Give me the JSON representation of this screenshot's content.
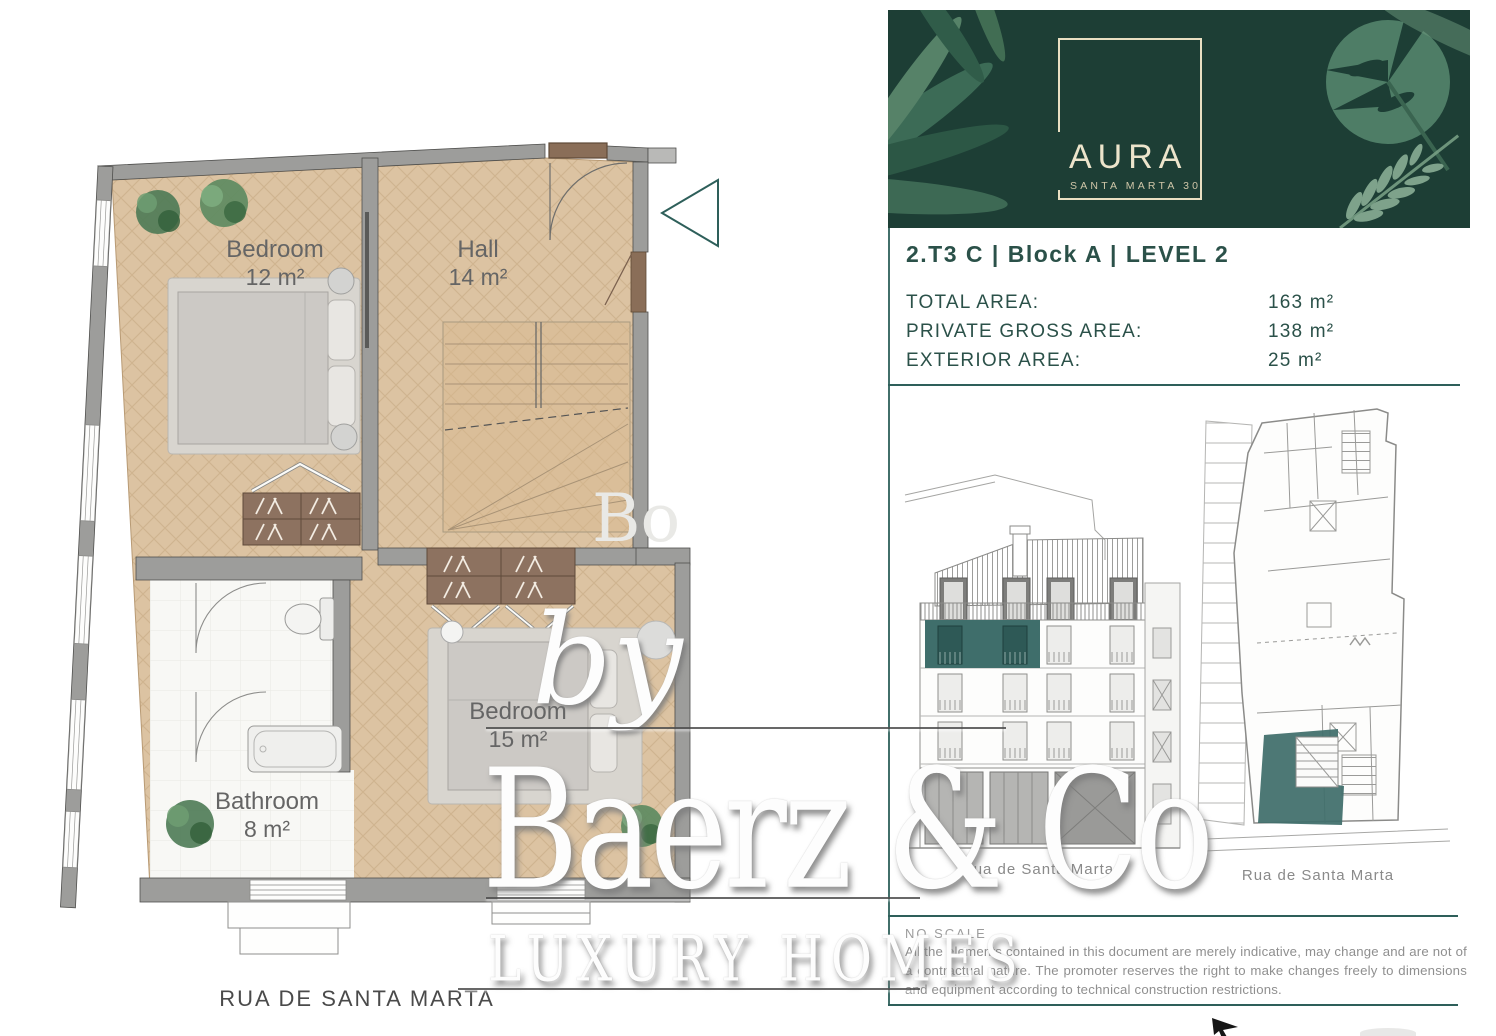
{
  "header": {
    "logo_title": "AURA",
    "logo_subtitle": "SANTA MARTA 30"
  },
  "unit": {
    "title": "2.T3 C | Block A | LEVEL 2",
    "areas": [
      {
        "label": "TOTAL AREA:",
        "value": "163 m²"
      },
      {
        "label": "PRIVATE GROSS AREA:",
        "value": "138 m²"
      },
      {
        "label": "EXTERIOR AREA:",
        "value": "25 m²"
      }
    ]
  },
  "plan": {
    "rooms": {
      "bedroom1": {
        "name": "Bedroom",
        "area": "12 m²"
      },
      "hall": {
        "name": "Hall",
        "area": "14 m²"
      },
      "bathroom": {
        "name": "Bathroom",
        "area": "8 m²"
      },
      "bedroom2": {
        "name": "Bedroom",
        "area": "15 m²"
      }
    },
    "street": "RUA DE SANTA MARTA"
  },
  "captions": {
    "elevation": "Rua de Santa Marta",
    "siteplan": "Rua de Santa Marta"
  },
  "footer": {
    "no_scale": "NO SCALE",
    "disclaimer": "All the elements contained in this document are merely indicative, may change and are not of a contractual nature. The promoter reserves the right to make changes freely to dimensions and equipment according to technical construction restrictions."
  },
  "watermark": {
    "by": "by",
    "name": "Baerz & Co",
    "tagline": "LUXURY HOMES",
    "fragment": "Bo"
  },
  "colors": {
    "banner_green": "#1d3e35",
    "accent_teal": "#2e5f5a",
    "highlight_teal": "#3f6e6b",
    "heading_text": "#2b5149",
    "floor_tan": "#dcc3a2",
    "wall_gray": "#9d9d9b"
  }
}
